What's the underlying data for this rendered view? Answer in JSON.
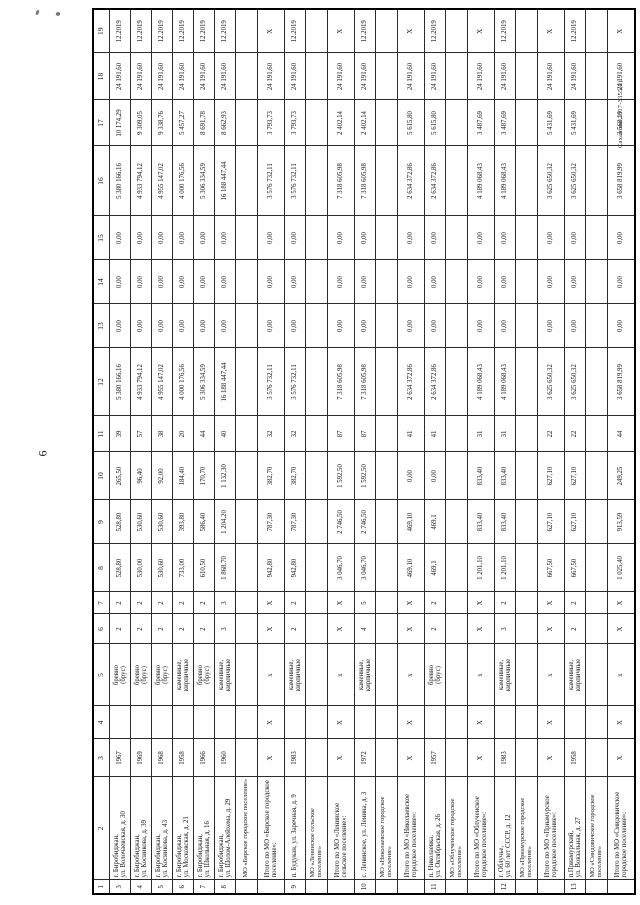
{
  "page": {
    "number": "6",
    "doc_ref": "Саханова/2017-3355(2)"
  },
  "table": {
    "column_numbers": [
      "1",
      "2",
      "3",
      "4",
      "5",
      "6",
      "7",
      "8",
      "9",
      "10",
      "11",
      "12",
      "13",
      "14",
      "15",
      "16",
      "17",
      "18",
      "19"
    ],
    "rows": [
      {
        "type": "data",
        "cells": [
          "3",
          "г. Биробиджан,\nул. Волочаевская, д. 30",
          "1967",
          "",
          "бревно\n(брус)",
          "2",
          "2",
          "528,80",
          "528,80",
          "265,50",
          "39",
          "5 380 166,16",
          "0,00",
          "0,00",
          "0,00",
          "5 380 166,16",
          "10 174,29",
          "24 191,60",
          "12.2019"
        ]
      },
      {
        "type": "data",
        "cells": [
          "4",
          "г. Биробиджан,\nул. Косникова, д. 39",
          "1969",
          "",
          "бревно\n(брус)",
          "2",
          "2",
          "530,00",
          "530,60",
          "96,40",
          "57",
          "4 933 794,12",
          "0,00",
          "0,00",
          "0,00",
          "4 933 794,12",
          "9 309,05",
          "24 191,60",
          "12.2019"
        ]
      },
      {
        "type": "data",
        "cells": [
          "5",
          "г. Биробиджан,\nул. Косникова, д. 43",
          "1968",
          "",
          "бревно\n(брус)",
          "2",
          "2",
          "530,60",
          "530,60",
          "92,00",
          "38",
          "4 955 147,02",
          "0,00",
          "0,00",
          "0,00",
          "4 955 147,02",
          "9 338,76",
          "24 191,60",
          "12.2019"
        ]
      },
      {
        "type": "data",
        "cells": [
          "6",
          "г. Биробиджан,\nул. Московская, д. 21",
          "1958",
          "",
          "каменные,\nкирпичные",
          "2",
          "2",
          "733,00",
          "393,80",
          "184,40",
          "20",
          "4 000 176,56",
          "0,00",
          "0,00",
          "0,00",
          "4 000 176,56",
          "5 457,27",
          "24 191,60",
          "12.2019"
        ]
      },
      {
        "type": "data",
        "cells": [
          "7",
          "г. Биробиджан,\nул. Школьная, д. 16",
          "1966",
          "",
          "бревно\n(брус)",
          "2",
          "2",
          "610,50",
          "586,40",
          "170,70",
          "44",
          "5 306 334,59",
          "0,00",
          "0,00",
          "0,00",
          "5 306 334,59",
          "8 691,78",
          "24 191,60",
          "12.2019"
        ]
      },
      {
        "type": "data",
        "cells": [
          "8",
          "г. Биробиджан,\nул. Шолом-Алейхема, д. 29",
          "1960",
          "",
          "каменные,\nкирпичные",
          "3",
          "3",
          "1 868,70",
          "1 204,20",
          "1 132,30",
          "40",
          "16 188 447,44",
          "0,00",
          "0,00",
          "0,00",
          "16 188 447,44",
          "8 662,93",
          "24 191,60",
          "12.2019"
        ]
      },
      {
        "type": "section",
        "cells": [
          "",
          "МО «Бирское городское поселение»",
          "",
          "",
          "",
          "",
          "",
          "",
          "",
          "",
          "",
          "",
          "",
          "",
          "",
          "",
          "",
          "",
          ""
        ]
      },
      {
        "type": "total",
        "cells": [
          "",
          "Итого по МО «Бирское городское поселение»:",
          "X",
          "X",
          "х",
          "X",
          "X",
          "942,80",
          "787,30",
          "382,70",
          "32",
          "3 576 732,11",
          "0,00",
          "0,00",
          "0,00",
          "3 576 732,11",
          "3 793,73",
          "24 191,60",
          "X"
        ]
      },
      {
        "type": "data",
        "cells": [
          "9",
          "п. Будукан, ул. Заречная, д. 9",
          "1983",
          "",
          "каменные,\nкирпичные",
          "2",
          "2",
          "942,80",
          "787,30",
          "382,70",
          "32",
          "3 576 732,11",
          "0,00",
          "0,00",
          "0,00",
          "3 576 732,11",
          "3 793,73",
          "24 191,60",
          "12.2019"
        ]
      },
      {
        "type": "section",
        "cells": [
          "",
          "МО «Ленинское сельское поселение»",
          "",
          "",
          "",
          "",
          "",
          "",
          "",
          "",
          "",
          "",
          "",
          "",
          "",
          "",
          "",
          "",
          ""
        ]
      },
      {
        "type": "total",
        "cells": [
          "",
          "Итого по МО «Ленинское сельское поселение»:",
          "X",
          "X",
          "х",
          "X",
          "X",
          "3 046,70",
          "2 746,50",
          "1 592,50",
          "87",
          "7 318 605,98",
          "0,00",
          "0,00",
          "0,00",
          "7 318 605,98",
          "2 402,14",
          "24 191,60",
          "X"
        ]
      },
      {
        "type": "data",
        "cells": [
          "10",
          "с. Ленинское, ул. Ленина, д. 3",
          "1972",
          "",
          "каменные,\nкирпичные",
          "4",
          "5",
          "3 046,70",
          "2 746,50",
          "1 592,50",
          "87",
          "7 318 605,98",
          "0,00",
          "0,00",
          "0,00",
          "7 318 605,98",
          "2 402,14",
          "24 191,60",
          "12.2019"
        ]
      },
      {
        "type": "section",
        "cells": [
          "",
          "МО «Николаевское городское поселение»",
          "",
          "",
          "",
          "",
          "",
          "",
          "",
          "",
          "",
          "",
          "",
          "",
          "",
          "",
          "",
          "",
          ""
        ]
      },
      {
        "type": "total",
        "cells": [
          "",
          "Итого по МО «Николаевское городское поселение»:",
          "X",
          "X",
          "х",
          "X",
          "X",
          "469,10",
          "469,10",
          "0,00",
          "41",
          "2 634 372,86",
          "0,00",
          "0,00",
          "0,00",
          "2 634 372,86",
          "5 615,80",
          "24 191,60",
          "X"
        ]
      },
      {
        "type": "data",
        "cells": [
          "11",
          "п. Николаевка,\nул. Октябрьская, д. 26",
          "1957",
          "",
          "бревно\n(брус)",
          "2",
          "2",
          "469,1",
          "469,1",
          "0,00",
          "41",
          "2 634 372,86",
          "0,00",
          "0,00",
          "0,00",
          "2 634 372,86",
          "5 615,80",
          "24 191,60",
          "12.2019"
        ]
      },
      {
        "type": "section",
        "cells": [
          "",
          "МО «Облученское городское поселение»",
          "",
          "",
          "",
          "",
          "",
          "",
          "",
          "",
          "",
          "",
          "",
          "",
          "",
          "",
          "",
          "",
          ""
        ]
      },
      {
        "type": "total",
        "cells": [
          "",
          "Итого по МО «Облученское городское поселение»:",
          "X",
          "X",
          "х",
          "X",
          "X",
          "1 201,10",
          "833,40",
          "833,40",
          "31",
          "4 189 068,43",
          "0,00",
          "0,00",
          "0,00",
          "4 189 068,43",
          "3 487,69",
          "24 191,60",
          "X"
        ]
      },
      {
        "type": "data",
        "cells": [
          "12",
          "г. Облучье,\nул. 60 лет СССР, д. 12",
          "1983",
          "",
          "каменные,\nкирпичные",
          "3",
          "2",
          "1 201,10",
          "833,40",
          "833,40",
          "31",
          "4 189 068,43",
          "0,00",
          "0,00",
          "0,00",
          "4 189 068,43",
          "3 487,69",
          "24 191,60",
          "12.2019"
        ]
      },
      {
        "type": "section",
        "cells": [
          "",
          "МО «Приамурское городское поселение»",
          "",
          "",
          "",
          "",
          "",
          "",
          "",
          "",
          "",
          "",
          "",
          "",
          "",
          "",
          "",
          "",
          ""
        ]
      },
      {
        "type": "total",
        "cells": [
          "",
          "Итого по МО «Приамурское городское поселение»:",
          "X",
          "X",
          "х",
          "X",
          "X",
          "667,50",
          "627,10",
          "627,10",
          "22",
          "3 625 650,32",
          "0,00",
          "0,00",
          "0,00",
          "3 625 650,32",
          "5 431,69",
          "24 191,60",
          "X"
        ]
      },
      {
        "type": "data",
        "cells": [
          "13",
          "п.Приамурский,\nул. Вокзальная, д. 27",
          "1958",
          "",
          "каменные,\nкирпичные",
          "2",
          "2",
          "667,50",
          "627,10",
          "627,10",
          "22",
          "3 625 650,32",
          "0,00",
          "0,00",
          "0,00",
          "3 625 650,32",
          "5 431,69",
          "24 191,60",
          "12.2019"
        ]
      },
      {
        "type": "section",
        "cells": [
          "",
          "МО «Смидовичское городское поселение»",
          "",
          "",
          "",
          "",
          "",
          "",
          "",
          "",
          "",
          "",
          "",
          "",
          "",
          "",
          "",
          "",
          ""
        ]
      },
      {
        "type": "total",
        "cells": [
          "",
          "Итого по МО «Смидовичское городское поселение»:",
          "X",
          "X",
          "х",
          "X",
          "X",
          "1 025,40",
          "913,59",
          "249,25",
          "44",
          "3 658 819,99",
          "0,00",
          "0,00",
          "0,00",
          "3 658 819,99",
          "3 568,19",
          "24 191,60",
          "X"
        ]
      }
    ]
  }
}
